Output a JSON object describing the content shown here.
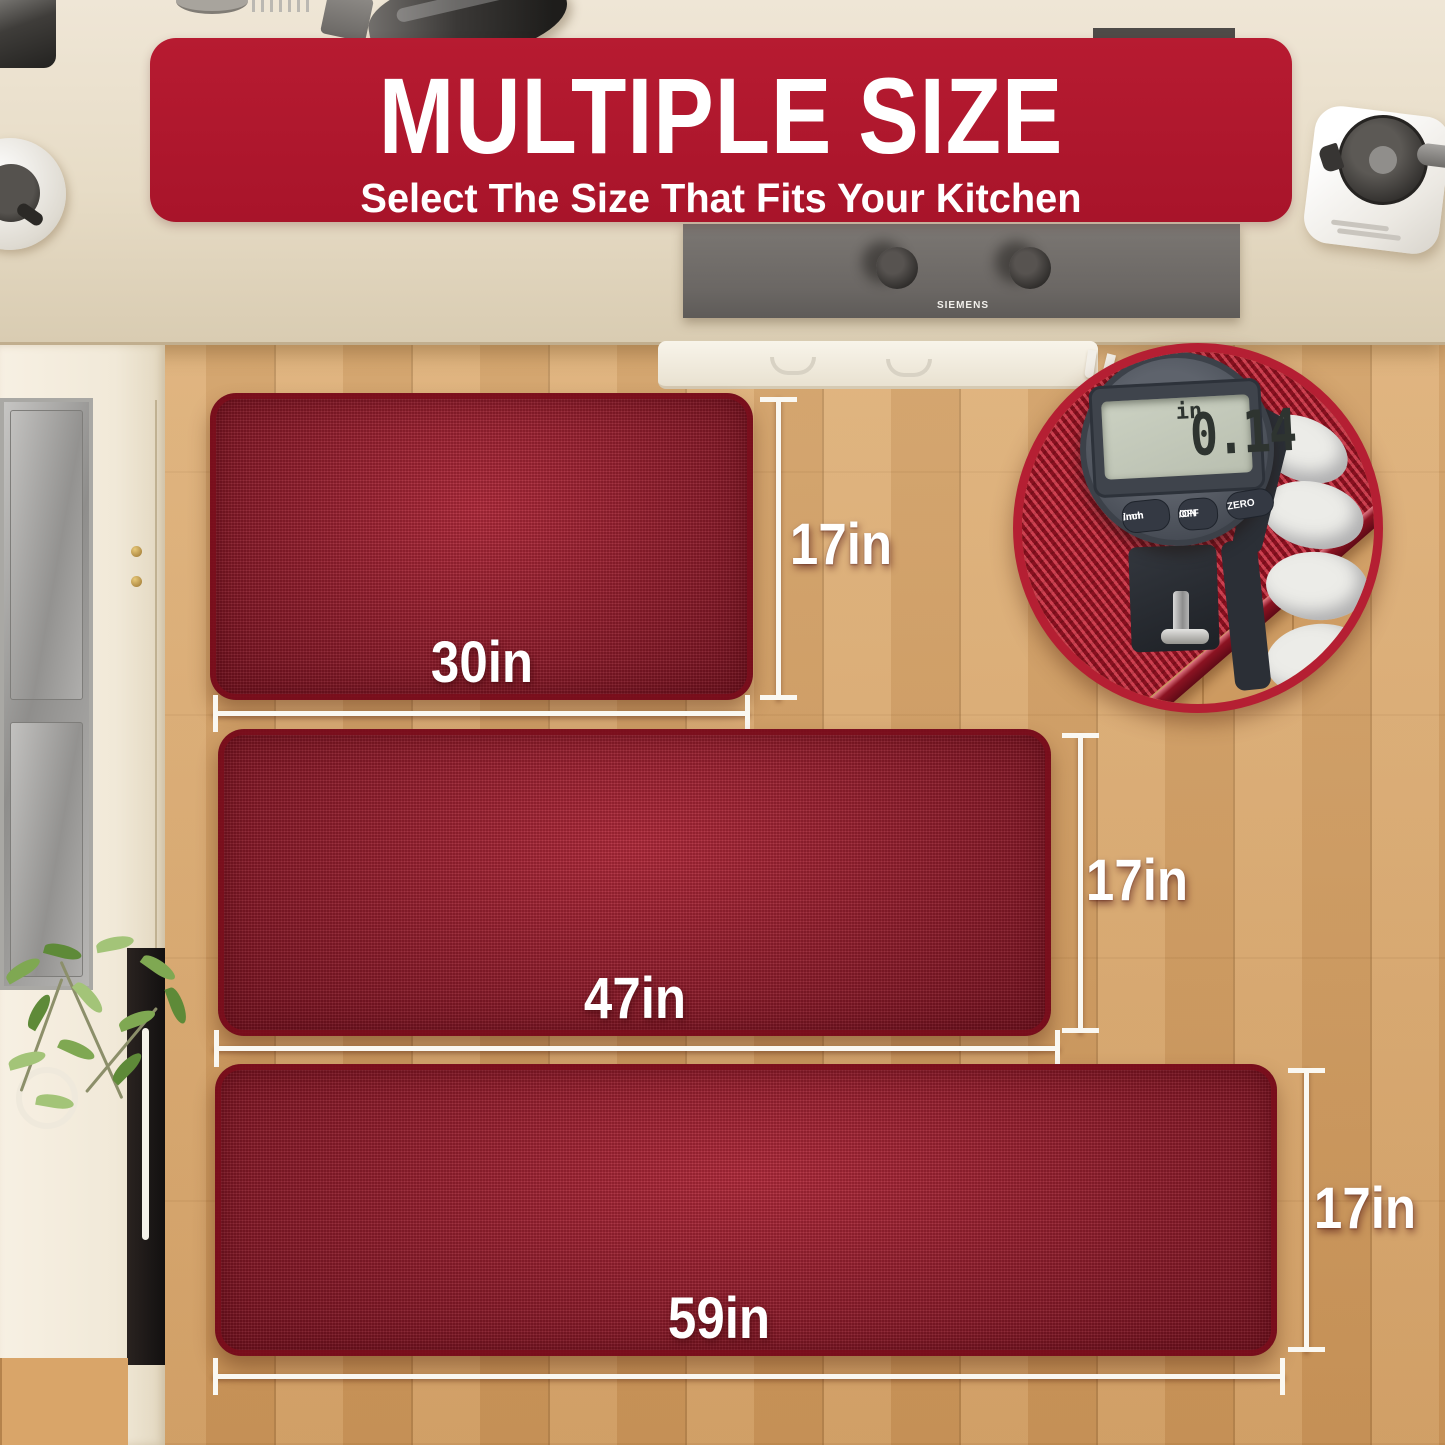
{
  "banner": {
    "title": "MULTIPLE SIZE",
    "subtitle": "Select The Size That Fits Your Kitchen"
  },
  "mats": [
    {
      "name": "small",
      "width_label": "30in",
      "height_label": "17in"
    },
    {
      "name": "medium",
      "width_label": "47in",
      "height_label": "17in"
    },
    {
      "name": "large",
      "width_label": "59in",
      "height_label": "17in"
    }
  ],
  "thickness_gauge": {
    "reading": "0.14",
    "unit": "in",
    "button_inch_line1": "inch",
    "button_inch_line2": "/mm",
    "button_onoff_line1": "OFF",
    "button_onoff_line2": "/ON",
    "button_zero": "ZERO"
  },
  "cooktop": {
    "brand": "SIEMENS"
  },
  "colors": {
    "banner_red": "#B2182E",
    "mat_red": "#A01D2F",
    "inset_ring_red": "#B51F33",
    "floor_wood": "#DAA76C",
    "counter_beige": "#E8DEC9",
    "measure_line_white": "#FAF8F2",
    "gauge_body_gray": "#4A4F58",
    "lcd_green_gray": "#C3C9BA"
  }
}
